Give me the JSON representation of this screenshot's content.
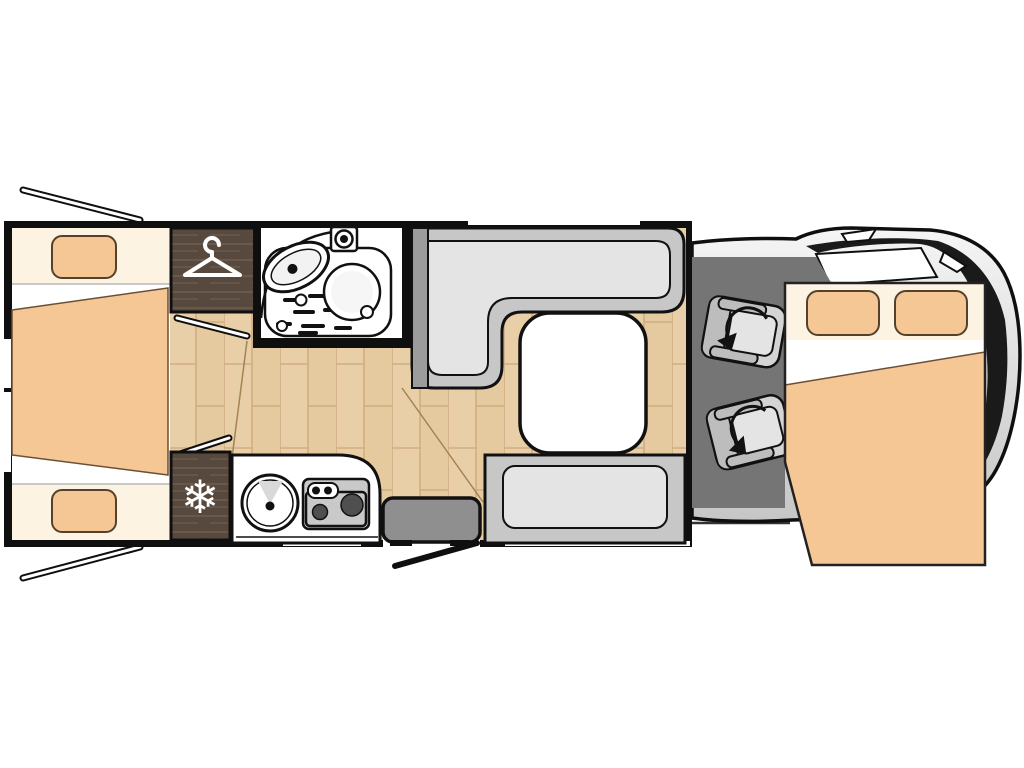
{
  "figure": {
    "kind": "motorhome-floorplan",
    "view": "top-down",
    "cab_side": "right"
  },
  "icons": {
    "wardrobe": "hanger-icon",
    "fridge": "snowflake-icon",
    "fridge_glyph": "❄",
    "seats": "rotate-arrow-icon"
  },
  "areas": {
    "rear_bedroom": "twin-single-beds-with-center-extension",
    "wardrobe": "wardrobe",
    "bathroom": "washroom-shower-sink-toilet",
    "fridge": "refrigerator",
    "kitchen": "kitchenette-sink-two-burner-hob",
    "entrance": "entry-door-with-step",
    "dinette": "l-shaped-dinette-with-table-and-bench",
    "cab": "driver-cab-two-swivel-seats",
    "overcab_bed": "drop-down-double-bed"
  },
  "colors": {
    "bg": "#ffffff",
    "wall": "#0f0f0f",
    "outline": "#111111",
    "cream": "#fdf3e3",
    "peach": "#f5c794",
    "peach_line": "#6b4f35",
    "pillow_line": "#55402c",
    "soft_line": "#b9b9b9",
    "wood_base": "#e9cfa7",
    "wood_line": "#cfae80",
    "wood_shade": "#e2c69b",
    "wood_seam": "#a08456",
    "darkwood": "#57493d",
    "darkwood_line": "#6e5e50",
    "bench": "#c7c7c7",
    "cushion": "#e4e4e4",
    "bench_side": "#9c9c9c",
    "stove": "#c9c9c9",
    "burner": "#4f4f4f",
    "step": "#8f8f8f",
    "cab_floor": "#757575",
    "seat": "#d4d4d4",
    "seat_dark": "#bdbdbd",
    "body_light": "#f5f5f5",
    "body_dark": "#c6c6c6",
    "glass_dark": "#1a1a1a"
  }
}
